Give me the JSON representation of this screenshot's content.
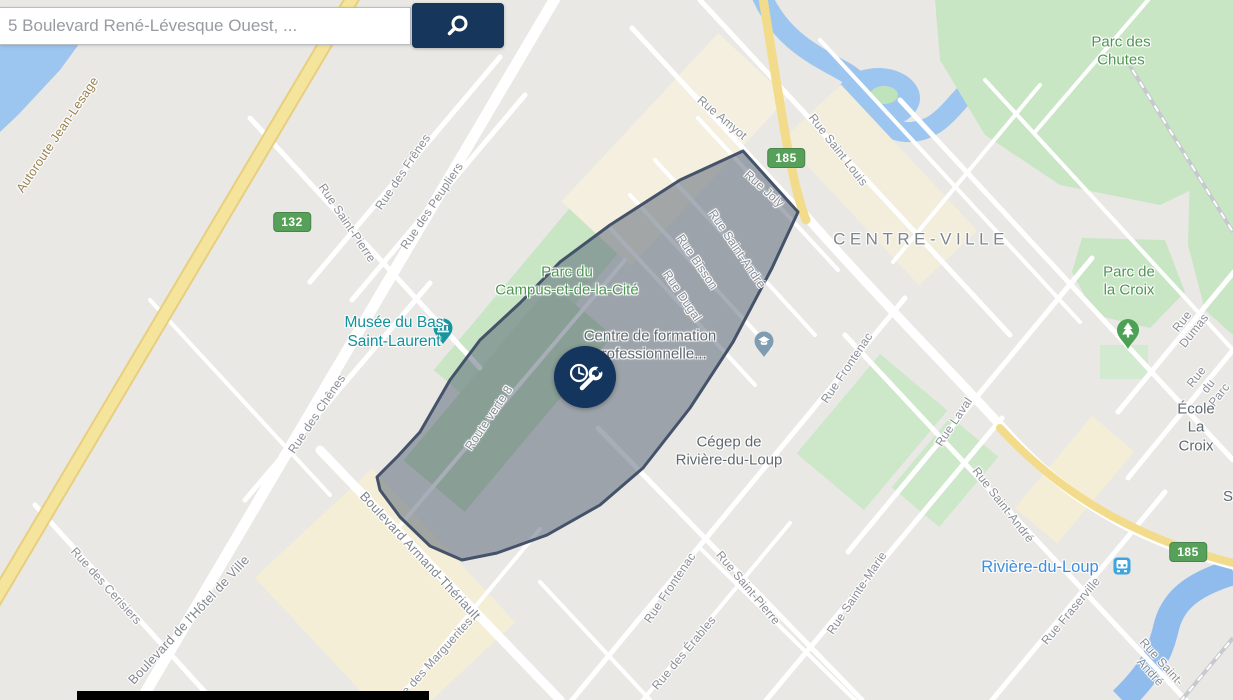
{
  "search": {
    "query": "5 Boulevard René-Lévesque Ouest, ...",
    "button_icon": "magnifier-icon"
  },
  "colors": {
    "accent_navy": "#14355E",
    "badge_green": "#57A05A",
    "park_fill": "#C8E6C4",
    "park_label_green": "#4E9553",
    "water_blue": "#9CC6F0",
    "road_yellow": "#F2DC8C",
    "poi_teal": "#12919B",
    "poi_gray": "#5F6870",
    "street_label_gray": "#8A8E96",
    "highway_label_brown": "#99824F",
    "transit_blue": "#3FA4DF",
    "place_link_blue": "#3E8EDE",
    "area_label_gray": "#7D868D",
    "polygon_fill": "rgba(79,93,112,0.5)",
    "polygon_stroke": "#44526A"
  },
  "marker": {
    "icon": "clock-wrench-icon"
  },
  "map": {
    "badges": [
      {
        "text": "132",
        "x": 292,
        "y": 222
      },
      {
        "text": "185",
        "x": 786,
        "y": 158
      },
      {
        "text": "185",
        "x": 1188,
        "y": 552
      }
    ],
    "labels": [
      {
        "text": "Autoroute Jean-Lesage",
        "x": 58,
        "y": 135,
        "rot": -56,
        "kind": "highway"
      },
      {
        "text": "Rue Amyot",
        "x": 722,
        "y": 118,
        "rot": 40,
        "kind": "street"
      },
      {
        "text": "Rue Saint Louis",
        "x": 838,
        "y": 150,
        "rot": 52,
        "kind": "street"
      },
      {
        "text": "Rue Joly",
        "x": 764,
        "y": 189,
        "rot": 42,
        "kind": "street"
      },
      {
        "text": "Rue Saint-André",
        "x": 737,
        "y": 249,
        "rot": 56,
        "kind": "street"
      },
      {
        "text": "Rue Bisson",
        "x": 697,
        "y": 262,
        "rot": 56,
        "kind": "street"
      },
      {
        "text": "Rue Dugal",
        "x": 682,
        "y": 296,
        "rot": 56,
        "kind": "street"
      },
      {
        "text": "Rue Saint-Pierre",
        "x": 347,
        "y": 223,
        "rot": 56,
        "kind": "street"
      },
      {
        "text": "Rue des Frênes",
        "x": 403,
        "y": 172,
        "rot": -56,
        "kind": "street"
      },
      {
        "text": "Rue des Peupliers",
        "x": 432,
        "y": 206,
        "rot": -56,
        "kind": "street"
      },
      {
        "text": "Rue des Chênes",
        "x": 317,
        "y": 414,
        "rot": -56,
        "kind": "street"
      },
      {
        "text": "Route verte 8",
        "x": 489,
        "y": 418,
        "rot": -56,
        "kind": "street"
      },
      {
        "text": "Boulevard de l'Hôtel de Ville",
        "x": 189,
        "y": 620,
        "rot": -47,
        "kind": "street-lg"
      },
      {
        "text": "Boulevard Armand-Thériault",
        "x": 420,
        "y": 556,
        "rot": 47,
        "kind": "street-lg"
      },
      {
        "text": "Rue des Cerisiers",
        "x": 106,
        "y": 586,
        "rot": 48,
        "kind": "street"
      },
      {
        "text": "Rue des Marguerites",
        "x": 432,
        "y": 662,
        "rot": -48,
        "kind": "street"
      },
      {
        "text": "Rue Frontenac",
        "x": 670,
        "y": 588,
        "rot": -56,
        "kind": "street"
      },
      {
        "text": "Rue Frontenac",
        "x": 847,
        "y": 368,
        "rot": -56,
        "kind": "street"
      },
      {
        "text": "Rue Saint-Pierre",
        "x": 748,
        "y": 588,
        "rot": 50,
        "kind": "street"
      },
      {
        "text": "Rue Sainte-Marie",
        "x": 857,
        "y": 593,
        "rot": -56,
        "kind": "street"
      },
      {
        "text": "Rue des Érables",
        "x": 684,
        "y": 653,
        "rot": -50,
        "kind": "street"
      },
      {
        "text": "Rue Laval",
        "x": 954,
        "y": 422,
        "rot": -56,
        "kind": "street"
      },
      {
        "text": "Rue Saint-André",
        "x": 1003,
        "y": 505,
        "rot": 52,
        "kind": "street"
      },
      {
        "text": "Rue Saint-André",
        "x": 1156,
        "y": 667,
        "rot": 48,
        "kind": "street"
      },
      {
        "text": "Rue Fraserville",
        "x": 1071,
        "y": 611,
        "rot": -50,
        "kind": "street"
      },
      {
        "text": "Rue Dumas",
        "x": 1188,
        "y": 326,
        "rot": -52,
        "kind": "street"
      },
      {
        "text": "Rue du Parc",
        "x": 1208,
        "y": 386,
        "rot": -52,
        "kind": "street"
      },
      {
        "text": "CENTRE-VILLE",
        "x": 921,
        "y": 240,
        "rot": 0,
        "kind": "area"
      },
      {
        "text": "Parc des\nChutes",
        "x": 1121,
        "y": 52,
        "rot": 0,
        "kind": "park"
      },
      {
        "text": "Parc de\nla Croix",
        "x": 1129,
        "y": 282,
        "rot": 0,
        "kind": "park"
      },
      {
        "text": "Parc du\nCampus-et-de-la-Cité",
        "x": 567,
        "y": 282,
        "rot": 0,
        "kind": "park"
      },
      {
        "text": "Musée du Bas\nSaint-Laurent",
        "x": 394,
        "y": 333,
        "rot": 0,
        "kind": "poi-teal"
      },
      {
        "text": "Centre de formation\nprofessionnelle...",
        "x": 650,
        "y": 346,
        "rot": 0,
        "kind": "poi"
      },
      {
        "text": "Cégep de\nRivière-du-Loup",
        "x": 729,
        "y": 452,
        "rot": 0,
        "kind": "poi"
      },
      {
        "text": "École La Croix",
        "x": 1196,
        "y": 428,
        "rot": 0,
        "kind": "poi"
      },
      {
        "text": "Rivière-du-Loup",
        "x": 1040,
        "y": 567,
        "rot": 0,
        "kind": "transit"
      },
      {
        "text": "S",
        "x": 1228,
        "y": 497,
        "rot": 0,
        "kind": "poi"
      }
    ]
  }
}
